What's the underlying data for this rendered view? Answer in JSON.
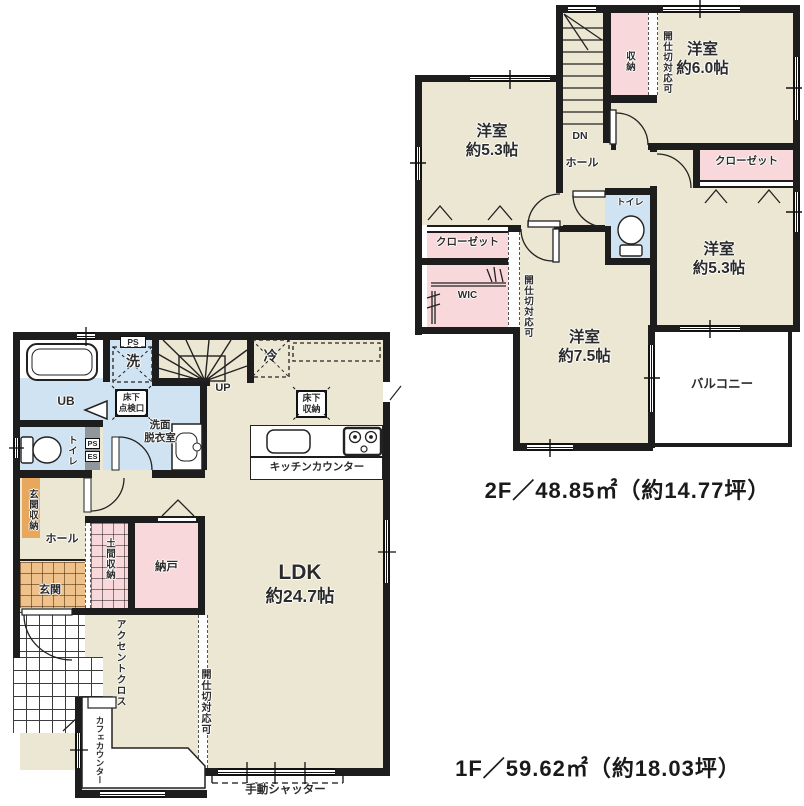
{
  "floor2": {
    "title": "2F／48.85㎡（約14.77坪）",
    "rooms": {
      "west_bedroom": {
        "name": "洋室",
        "size": "約5.3帖"
      },
      "northeast_bedroom": {
        "name": "洋室",
        "size": "約6.0帖"
      },
      "east_bedroom": {
        "name": "洋室",
        "size": "約5.3帖"
      },
      "south_bedroom": {
        "name": "洋室",
        "size": "約7.5帖"
      }
    },
    "labels": {
      "storage": "収納",
      "partition_north": "開仕切対応可",
      "partition_west": "開仕切対応可",
      "closet_east": "クローゼット",
      "closet_west": "クローゼット",
      "wic": "WIC",
      "toilet": "トイレ",
      "hall": "ホール",
      "down": "DN",
      "balcony": "バルコニー"
    }
  },
  "floor1": {
    "title": "1F／59.62㎡（約18.03坪）",
    "labels": {
      "ldk_name": "LDK",
      "ldk_size": "約24.7帖",
      "unit_bath": "UB",
      "washer": "洗",
      "ps_top": "PS",
      "up": "UP",
      "fridge": "冷",
      "floor_storage_1": "床下",
      "floor_storage_2": "収納",
      "floor_hatch_1": "床下",
      "floor_hatch_2": "点検口",
      "washroom_1": "洗面",
      "washroom_2": "脱衣室",
      "toilet": "トイレ",
      "ps": "PS",
      "es": "ES",
      "entrance_storage": "玄関収納",
      "hall": "ホール",
      "dirt_floor_storage": "土間収納",
      "storeroom": "納戸",
      "entrance": "玄関",
      "accent_cloth": "アクセントクロス",
      "partition": "開仕切対応可",
      "cafe_counter": "カフェカウンター",
      "kitchen_counter": "キッチンカウンター",
      "shutter": "手動シャッター"
    }
  },
  "colors": {
    "wall": "#1d1d1d",
    "floor_beige": "#ece7d2",
    "room_pink": "#f8d8da",
    "wet_area_blue": "#cfe3f2",
    "entrance_tile_orange": "#efc28b",
    "storage_orange": "#e7a75d"
  }
}
